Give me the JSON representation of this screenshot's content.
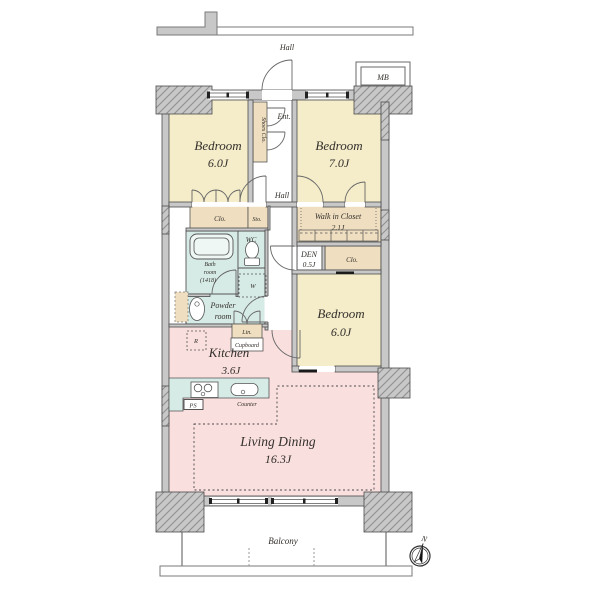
{
  "corridor": {
    "hall": "Hall"
  },
  "meter_box": {
    "label": "MB"
  },
  "rooms": {
    "bedroom1": {
      "name": "Bedroom",
      "size": "6.0J"
    },
    "bedroom2": {
      "name": "Bedroom",
      "size": "7.0J"
    },
    "bedroom3": {
      "name": "Bedroom",
      "size": "6.0J"
    },
    "living_dining": {
      "name": "Living Dining",
      "size": "16.3J"
    },
    "kitchen": {
      "name": "Kitchen",
      "size": "3.6J"
    },
    "walk_in_closet": {
      "name": "Walk in Closet",
      "size": "2.1J"
    },
    "den": {
      "name": "DEN",
      "size": "0.5J"
    },
    "bath": {
      "l1": "Bath",
      "l2": "room",
      "l3": "(1418)"
    },
    "powder": {
      "l1": "Powder",
      "l2": "room"
    },
    "wc": "WC",
    "hall": "Hall",
    "entrance": "Ent.",
    "balcony": "Balcony"
  },
  "storage": {
    "shoes_closet": "Shoes Clo.",
    "closet_left": "Clo.",
    "storage_small": "Sto.",
    "closet_right": "Clo.",
    "linen": "Lin.",
    "cupboard": "Cupboard",
    "washer": "W",
    "refrigerator": "R",
    "pipe_space": "PS",
    "counter": "Counter"
  },
  "compass": {
    "north": "N"
  },
  "colors": {
    "bedroom": "#f5edc9",
    "closet": "#efdfc0",
    "wet": "#d6eae6",
    "living": "#f9dfdd",
    "wall": "#c8c8c8",
    "white": "#ffffff"
  }
}
